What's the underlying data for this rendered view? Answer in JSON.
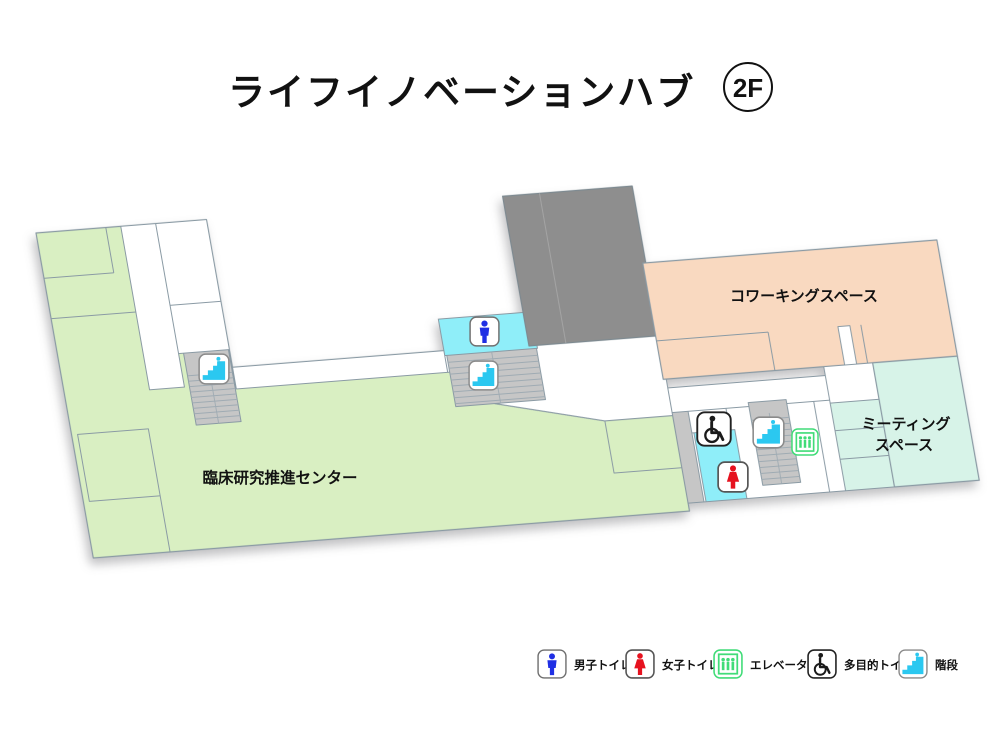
{
  "header": {
    "title": "ライフイノベーションハブ",
    "floor": "2F"
  },
  "rooms": {
    "clinical": {
      "label": "臨床研究推進センター",
      "color": "#d9efc2"
    },
    "coworking": {
      "label": "コワーキングスペース",
      "color": "#f9d9c0"
    },
    "meeting": {
      "label_line1": "ミーティング",
      "label_line2": "スペース",
      "color": "#d7f3e8"
    }
  },
  "legend": {
    "items": [
      {
        "icon": "mens-toilet-icon",
        "label": "男子トイレ"
      },
      {
        "icon": "womens-toilet-icon",
        "label": "女子トイレ"
      },
      {
        "icon": "elevator-icon",
        "label": "エレベーター"
      },
      {
        "icon": "accessible-toilet-icon",
        "label": "多目的トイレ"
      },
      {
        "icon": "stairs-icon",
        "label": "階段"
      }
    ]
  },
  "plan": {
    "icons": [
      "stairs",
      "mens-toilet",
      "stairs",
      "accessible-toilet",
      "womens-toilet",
      "stairs",
      "elevator"
    ]
  },
  "palette": {
    "green": "#d9efc2",
    "peach": "#f9d9c0",
    "mint": "#d7f3e8",
    "cyan": "#8feef9",
    "dark_gray": "#8e8e8e",
    "stair_gray": "#c6c6c6",
    "line": "#8a9aa4",
    "tread": "#9fabb3",
    "icon_blue": "#1f2fe4",
    "icon_red": "#e6121f",
    "icon_green": "#41dc78",
    "icon_cyan": "#2bc8f0",
    "icon_black": "#1a1a1a"
  }
}
